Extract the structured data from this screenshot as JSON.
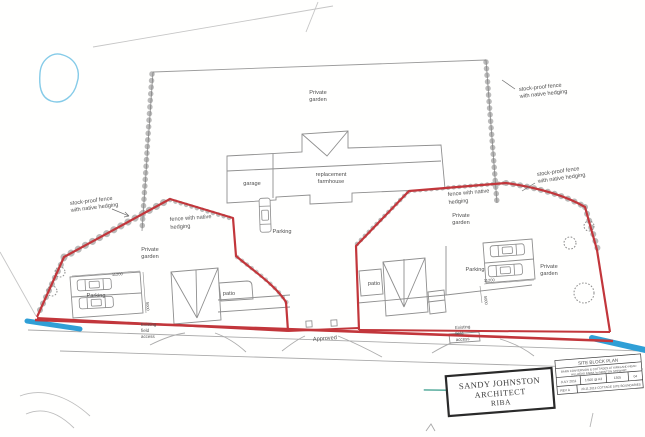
{
  "labels": {
    "private_garden": {
      "l1": "Private",
      "l2": "garden"
    },
    "garage": "garage",
    "farmhouse": {
      "l1": "replacement",
      "l2": "farmhouse"
    },
    "parking": "Parking",
    "patio": "patio",
    "approved": "Approved",
    "existing_access": {
      "l1": "Existing",
      "l2": "field",
      "l3": "access"
    },
    "stock_proof": {
      "l1": "stock-proof fence",
      "l2": "with native hedging"
    },
    "fence_hedging": {
      "l1": "fence with native",
      "l2": "hedging"
    },
    "dim_width": "11200",
    "dim_depth": "5000"
  },
  "title_block": {
    "architect_l1": "SANDY JOHNSTON",
    "architect_l2": "ARCHITECT",
    "architect_l3": "RIBA",
    "drawing_title": "SITE BLOCK PLAN",
    "project_l1": "BARN CONVERSION & COTTAGES AT KIRKLAND HEAD",
    "project_l2": "HILLHEAD FARM, by NEWTON STEWART",
    "date": "JULY 2011",
    "scale": "1:500 @ A3",
    "job_no": "1305",
    "sheet_no": "04",
    "rev": "REV A",
    "rev_note": "20.11.2012   COTTAGE SITE BOUNDARIES"
  },
  "colors": {
    "boundary_red": "#c2363b",
    "water_blue": "#2f9fd6",
    "pond_blue": "#85cbe8",
    "line_gray": "#9b9b9b",
    "hedge_gray": "#777777",
    "text_gray": "#4f4f4f"
  }
}
